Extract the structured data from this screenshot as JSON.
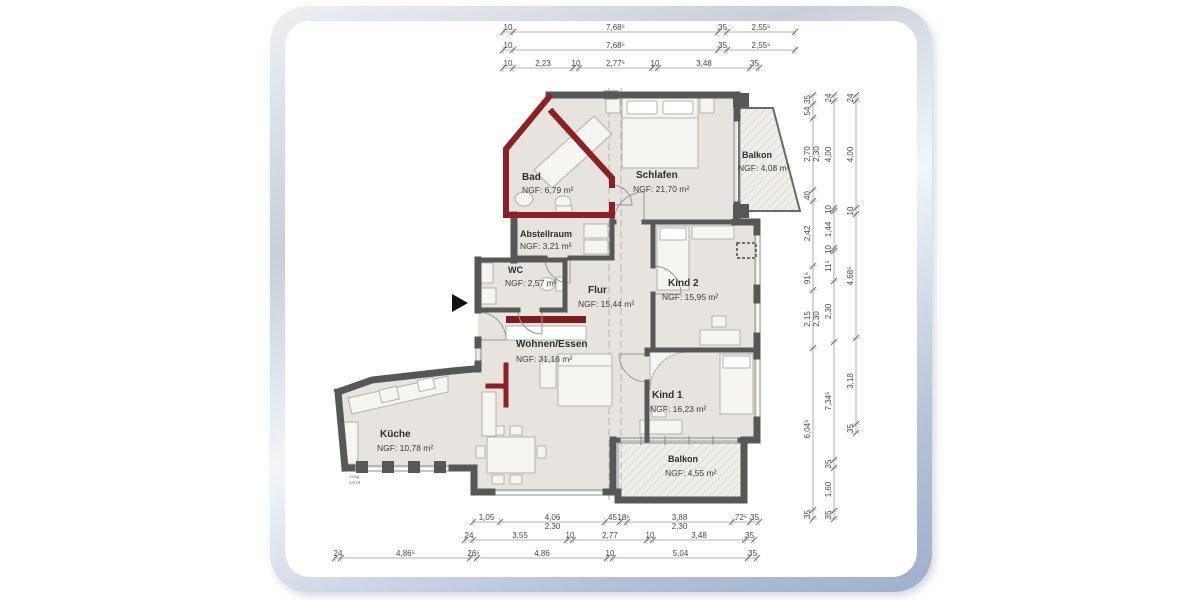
{
  "rooms": {
    "bad": {
      "name": "Bad",
      "area": "NGF: 6,79 m²"
    },
    "schlafen": {
      "name": "Schlafen",
      "area": "NGF: 21,70 m²"
    },
    "balkon_top": {
      "name": "Balkon",
      "area": "NGF: 4,08 m²"
    },
    "abstellraum": {
      "name": "Abstellraum",
      "area": "NGF: 3,21 m²"
    },
    "wc": {
      "name": "WC",
      "area": "NGF: 2,57 m²"
    },
    "flur": {
      "name": "Flur",
      "area": "NGF: 15,44 m²"
    },
    "kind2": {
      "name": "Kind 2",
      "area": "NGF: 15,95 m²"
    },
    "wohnen_essen": {
      "name": "Wohnen/Essen",
      "area": "NGF: 31,16 m²"
    },
    "kind1": {
      "name": "Kind 1",
      "area": "NGF: 16,23 m²"
    },
    "kueche": {
      "name": "Küche",
      "area": "NGF: 10,78 m²"
    },
    "balkon_bottom": {
      "name": "Balkon",
      "area": "NGF: 4,55 m²"
    }
  },
  "annotations": {
    "kitchen_note": [
      "Ausg.",
      "24/19"
    ]
  },
  "dimensions": {
    "top1": [
      "10",
      "7,68⁵",
      "35",
      "2,55⁵"
    ],
    "top2": [
      "10",
      "7,68⁵",
      "35",
      "2,55⁵"
    ],
    "top3": [
      "10",
      "2,23",
      "10",
      "2,77⁵",
      "10",
      "3,48",
      "35"
    ],
    "bottom1": [
      "1,05",
      "4,06|2,30",
      "45",
      "18⁵",
      "3,88|2,30",
      "72⁵",
      "35"
    ],
    "bottom2": [
      "24",
      "3,55",
      "10",
      "2,77",
      "10",
      "3,48",
      "35"
    ],
    "bottom3": [
      "24",
      "4,86⁵",
      "26⁵",
      "4,86",
      "10",
      "5,04",
      "35"
    ],
    "right1": [
      "35",
      "54",
      "2,70|2,30",
      "40",
      "2,42",
      "91⁵",
      "2,15|2,30",
      "6,04⁵",
      "35"
    ],
    "right2": [
      "24",
      "4,00",
      "10",
      "1,44",
      "10",
      "11⁵",
      "2,30",
      "7,34⁵",
      "35",
      "1,60",
      "35"
    ],
    "right3": [
      "24",
      "4,00",
      "10",
      "4,68⁵",
      "3,18",
      "35"
    ]
  },
  "colors": {
    "wall": "#575757",
    "renovation_wall": "#8e2022",
    "floor": "#e7e4df",
    "balcony_hatch": "#d6d3ce",
    "frame_silver": "#c9ced8",
    "frame_blue": "#9fb0cc"
  }
}
